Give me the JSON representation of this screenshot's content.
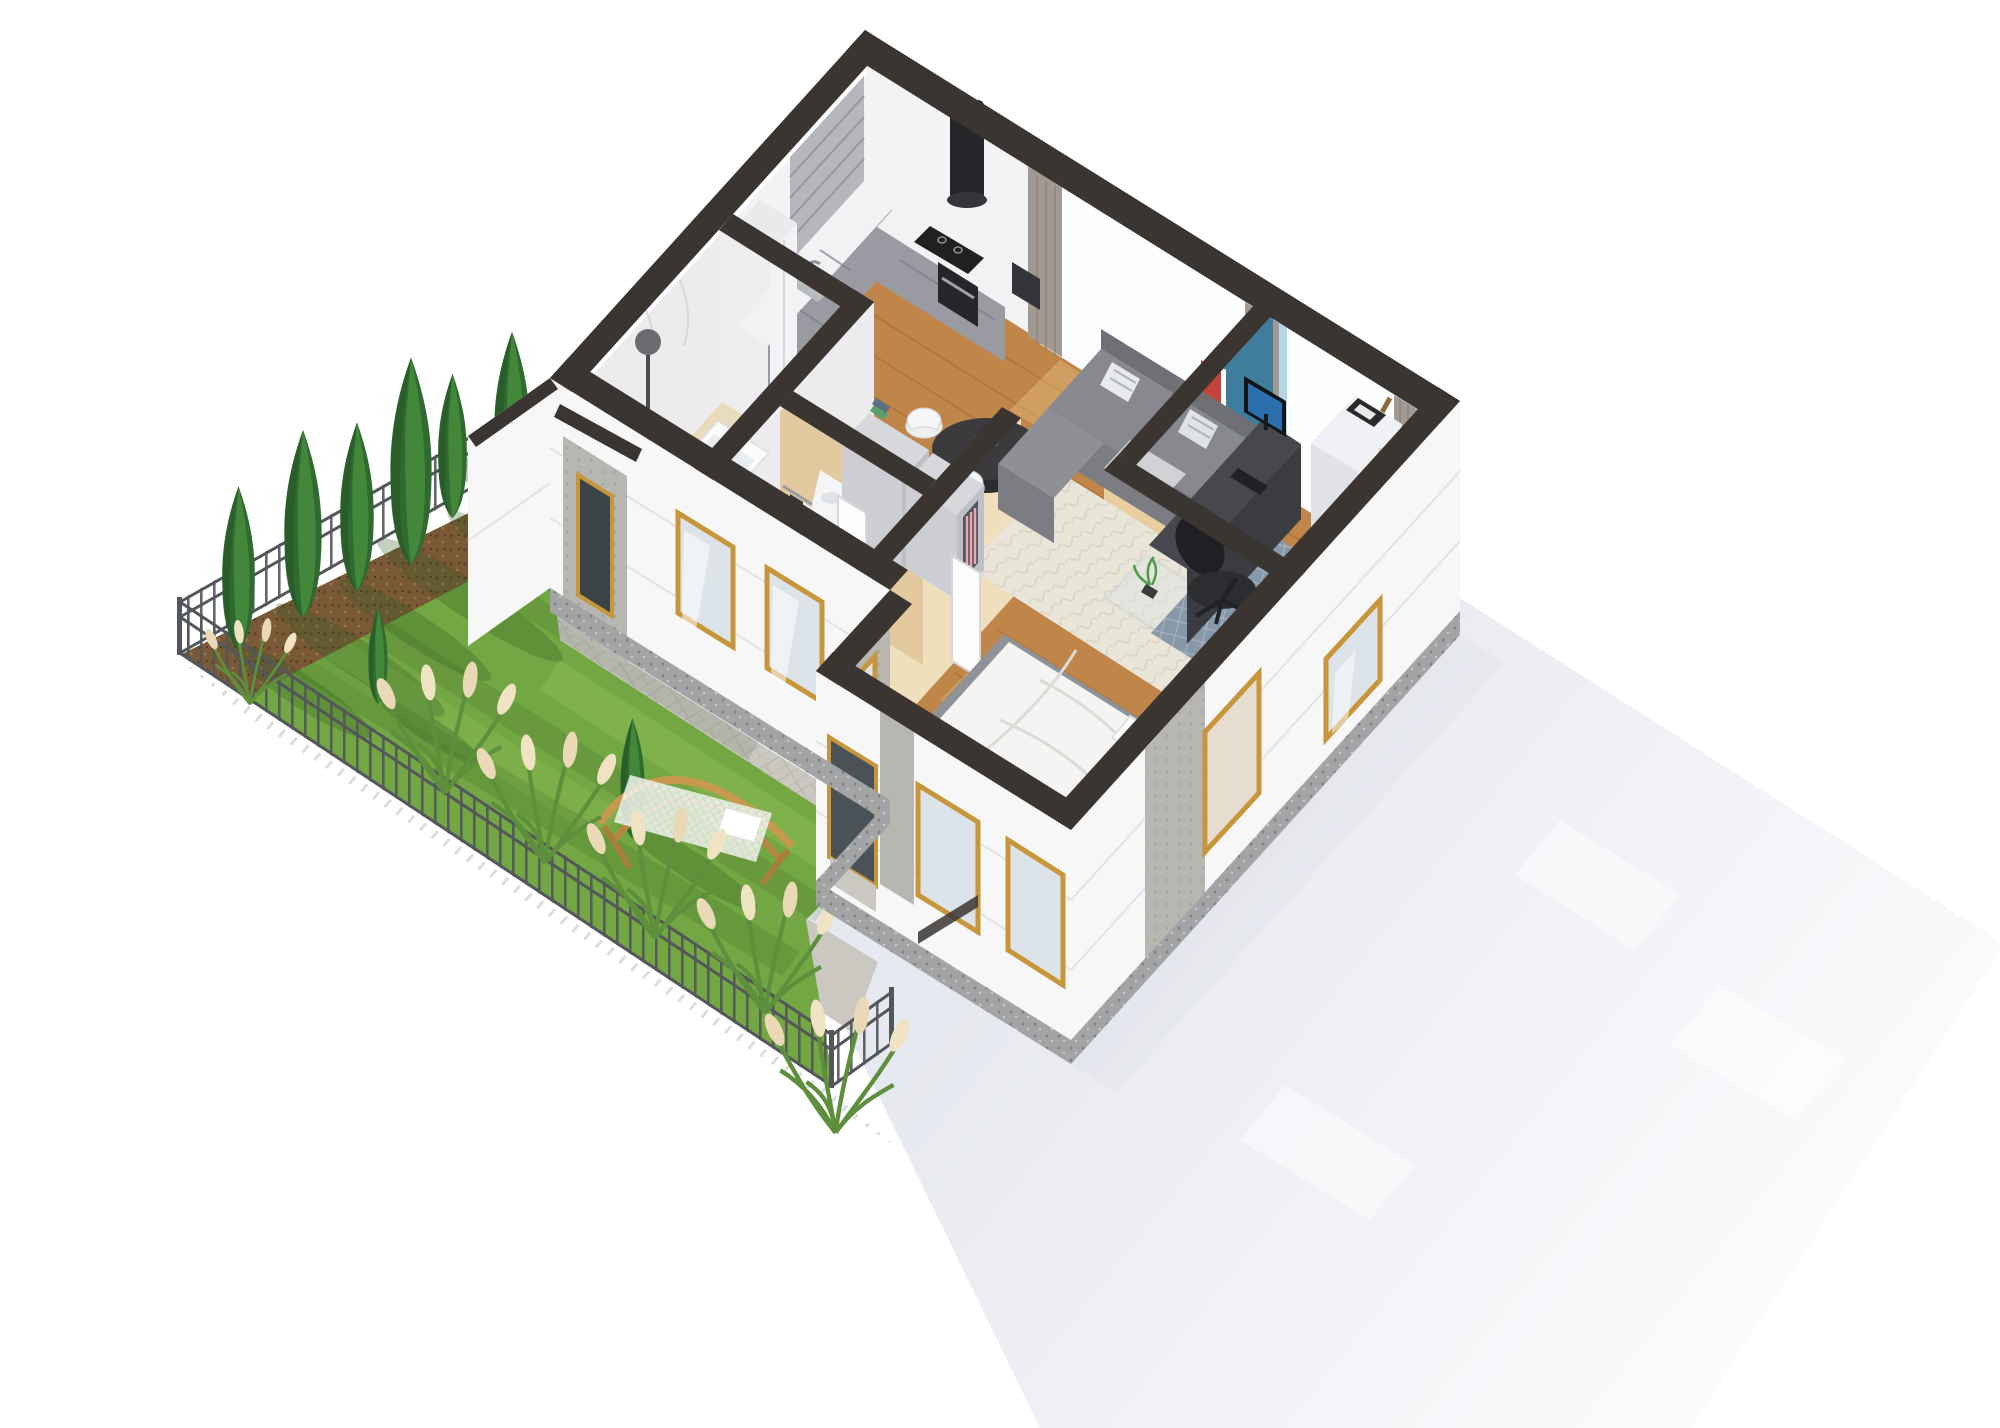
{
  "scene": {
    "type": "3d-isometric-apartment-floor-plan-render",
    "rooms": [
      "kitchen",
      "living-dining-room",
      "home-office",
      "bathroom",
      "hallway",
      "walk-in-closet",
      "bedroom"
    ],
    "garden_elements": [
      "lawn",
      "mulch-bed",
      "cypress-trees",
      "ornamental-grasses",
      "metal-fence",
      "hammock",
      "paved-path",
      "gravel-border"
    ],
    "cypress_tree_count": 9,
    "grass_clump_count": 6
  },
  "colors": {
    "background": "#ffffff",
    "shadow": "#e7e9f0",
    "shadow_deep": "#dcdfe8",
    "lawn": "#73a743",
    "lawn_light": "#92c45c",
    "mulch": "#7a5936",
    "fence": "#53565a",
    "paving": "#cbc8c1",
    "gravel": "#a3a4a6",
    "concrete": "#b7b6b1",
    "facade": "#f7f7f8",
    "roof_cap": "#3a3531",
    "wall_white": "#f3f3f5",
    "marble": "#ececee",
    "wood_floor": "#c08549",
    "bath_floor": "#e8dcbc",
    "counter": "#9a9aa2",
    "counter_top": "#f1f2f4",
    "appliance": "#26262a",
    "sofa": "#87898e",
    "rug_cream": "#eae5d9",
    "rug_blue": "#8798a8",
    "rug_gray": "#8f9398",
    "table": "#3b3b3e",
    "chair_white": "#eef0f2",
    "curtain": "#a29a92",
    "blue_wall": "#3f7d9e",
    "blue_wall_light": "#b2d8e8",
    "beige_wall": "#e9cfa0",
    "beige_wall_light": "#f0dfbd",
    "duvet": "#f5f4f2",
    "desk": "#46484e",
    "chair_black": "#2c2d30",
    "wardrobe": "#f2f3f5",
    "gold": "#c8963a",
    "glass": "#dde4e9",
    "tub": "#fbfbfc",
    "hammock_wood": "#c69a4e",
    "tv": "#2d2d2f",
    "screen": "#2a6fae",
    "plant": "#4e9a4a",
    "fruit": "#e8d944"
  }
}
